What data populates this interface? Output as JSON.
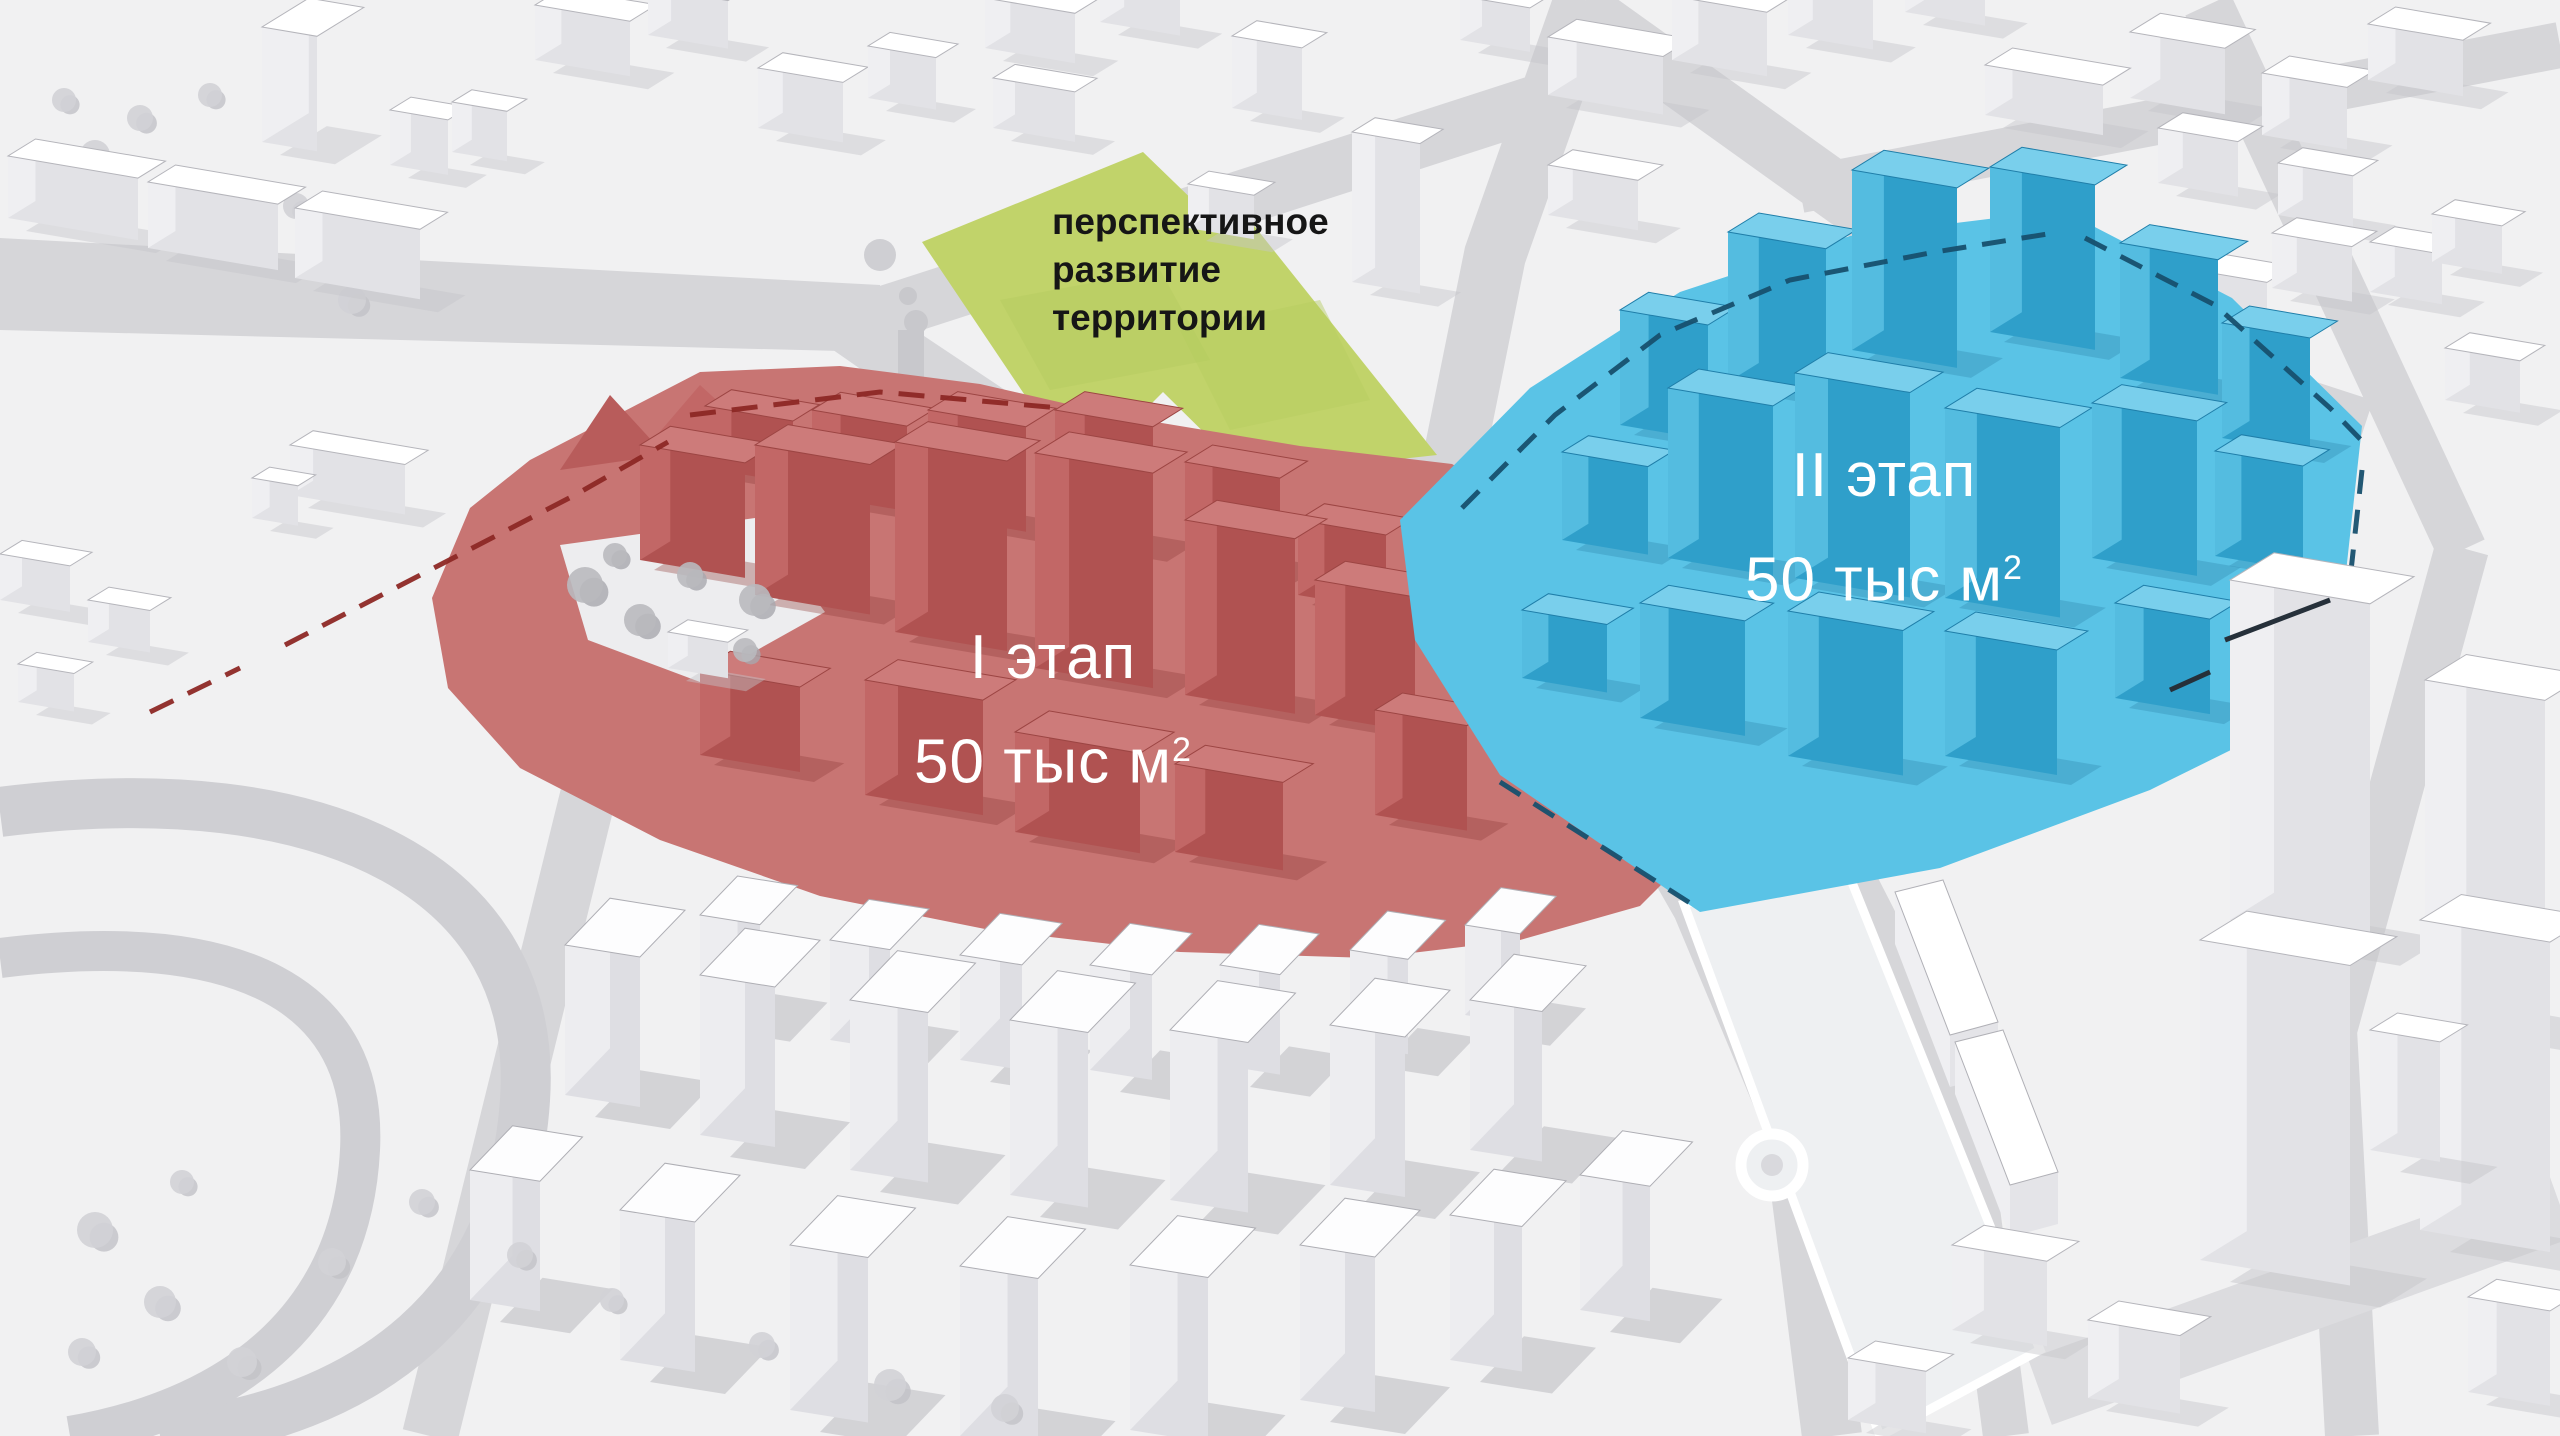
{
  "scene": {
    "background": "#f1f1f2",
    "road_color": "#d6d6d9",
    "building_color": "#ffffff",
    "boundary_dash_red": "#8d2825",
    "boundary_dash_blue": "#17506e"
  },
  "zones": {
    "future_development": {
      "label_lines": [
        "перспективное",
        "развитие",
        "территории"
      ],
      "fill": "#c1d36a",
      "text_color": "#161616"
    },
    "phase1": {
      "name": "I этап",
      "area_value": "50 тыс м",
      "area_superscript": "2",
      "fill": "#c87573",
      "text_color": "#ffffff"
    },
    "phase2": {
      "name": "II этап",
      "area_value": "50 тыс м",
      "area_superscript": "2",
      "fill": "#5ac3e6",
      "text_color": "#ffffff"
    }
  }
}
